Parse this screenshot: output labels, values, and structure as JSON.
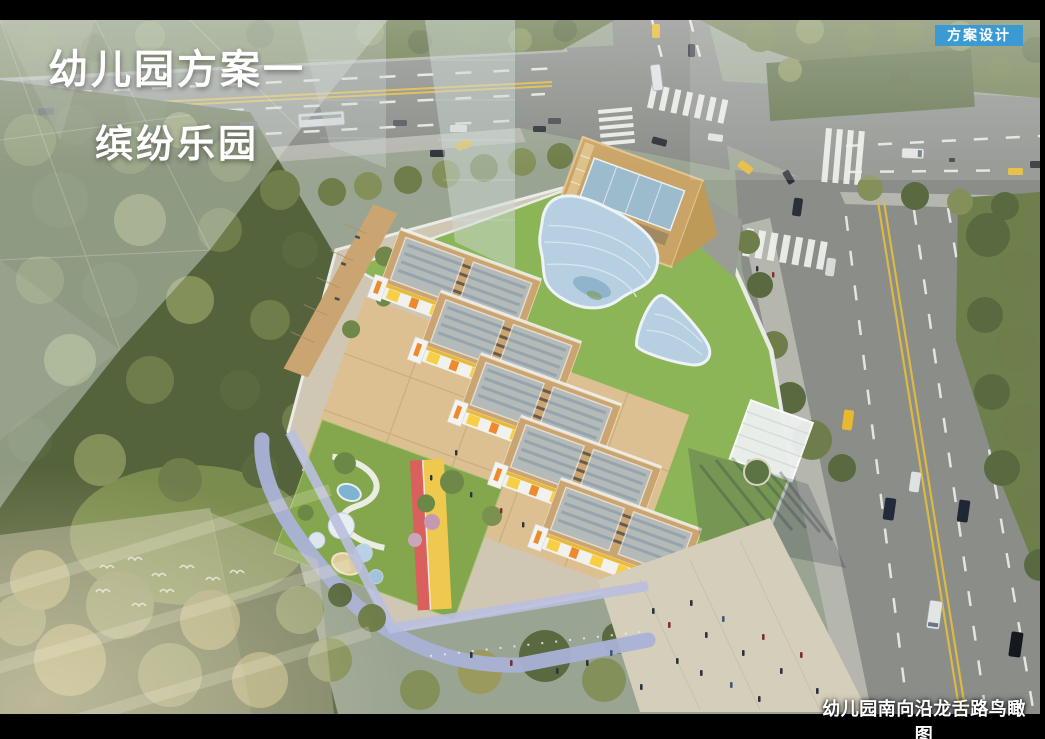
{
  "frame": {
    "background": "#000000"
  },
  "header": {
    "badge": {
      "label": "方案设计",
      "bg": "#3b9ad3",
      "fg": "#ffffff"
    }
  },
  "title": {
    "line1": "幼儿园方案一",
    "line2": "缤纷乐园",
    "color": "#ffffff"
  },
  "caption": {
    "text": "幼儿园南向沿龙舌路鸟瞰图",
    "color": "#ffffff"
  },
  "palette": {
    "road_asphalt": "#8a8d88",
    "forest_green": "#55633c",
    "roof_grass": "#8cb557",
    "lawn_green": "#84a64d",
    "wood_deck": "#cba571",
    "wood_box": "#c9a466",
    "skylight_glass": "#b7d0e1",
    "facade_yellow": "#f6cf45",
    "facade_orange": "#ee8a2e",
    "track_red": "#d9605c",
    "track_yellow": "#eec94d",
    "path_lavender": "#aab2d6",
    "plaza_paving": "#d4ceba",
    "taxi_yellow": "#e8b830"
  },
  "scene": {
    "alt": "幼儿园鸟瞰效果图：绿色屋顶建筑、彩色跑道游乐场，南侧沿龙舌路"
  }
}
